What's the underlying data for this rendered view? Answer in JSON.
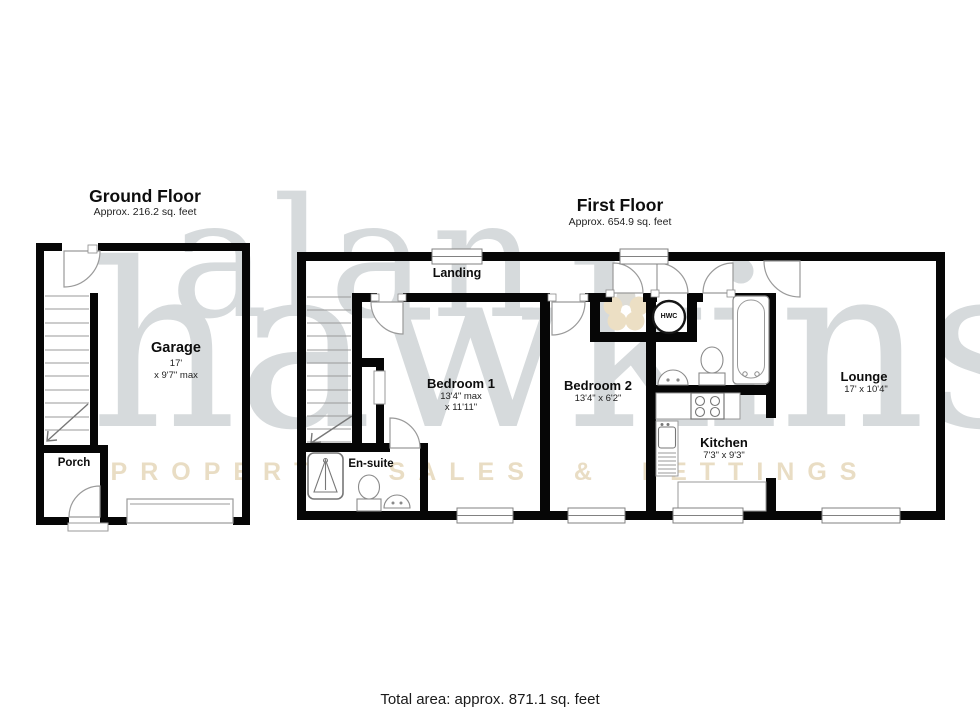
{
  "page": {
    "total_area": "Total area: approx. 871.1 sq. feet"
  },
  "watermark": {
    "brand_first": "alan",
    "brand_last": "hawkins",
    "tagline": "PROPERTY SALES & LETTINGS",
    "brand_color": "#d6dadc",
    "tagline_color": "#e9ddc4",
    "flower_color": "#ecdfc4"
  },
  "ground_floor": {
    "title": "Ground Floor",
    "subtitle": "Approx. 216.2 sq. feet",
    "garage": {
      "name": "Garage",
      "dim_line1": "17'",
      "dim_line2": "x 9'7\" max"
    },
    "porch": {
      "name": "Porch"
    }
  },
  "first_floor": {
    "title": "First Floor",
    "subtitle": "Approx. 654.9 sq. feet",
    "landing": {
      "name": "Landing"
    },
    "bedroom1": {
      "name": "Bedroom 1",
      "dim_line1": "13'4\" max",
      "dim_line2": "x 11'11\""
    },
    "bedroom2": {
      "name": "Bedroom 2",
      "dim": "13'4\" x 6'2\""
    },
    "lounge": {
      "name": "Lounge",
      "dim": "17' x 10'4\""
    },
    "kitchen": {
      "name": "Kitchen",
      "dim": "7'3\" x 9'3\""
    },
    "ensuite": {
      "name": "En-suite"
    },
    "hwc": {
      "name": "HWC"
    }
  }
}
